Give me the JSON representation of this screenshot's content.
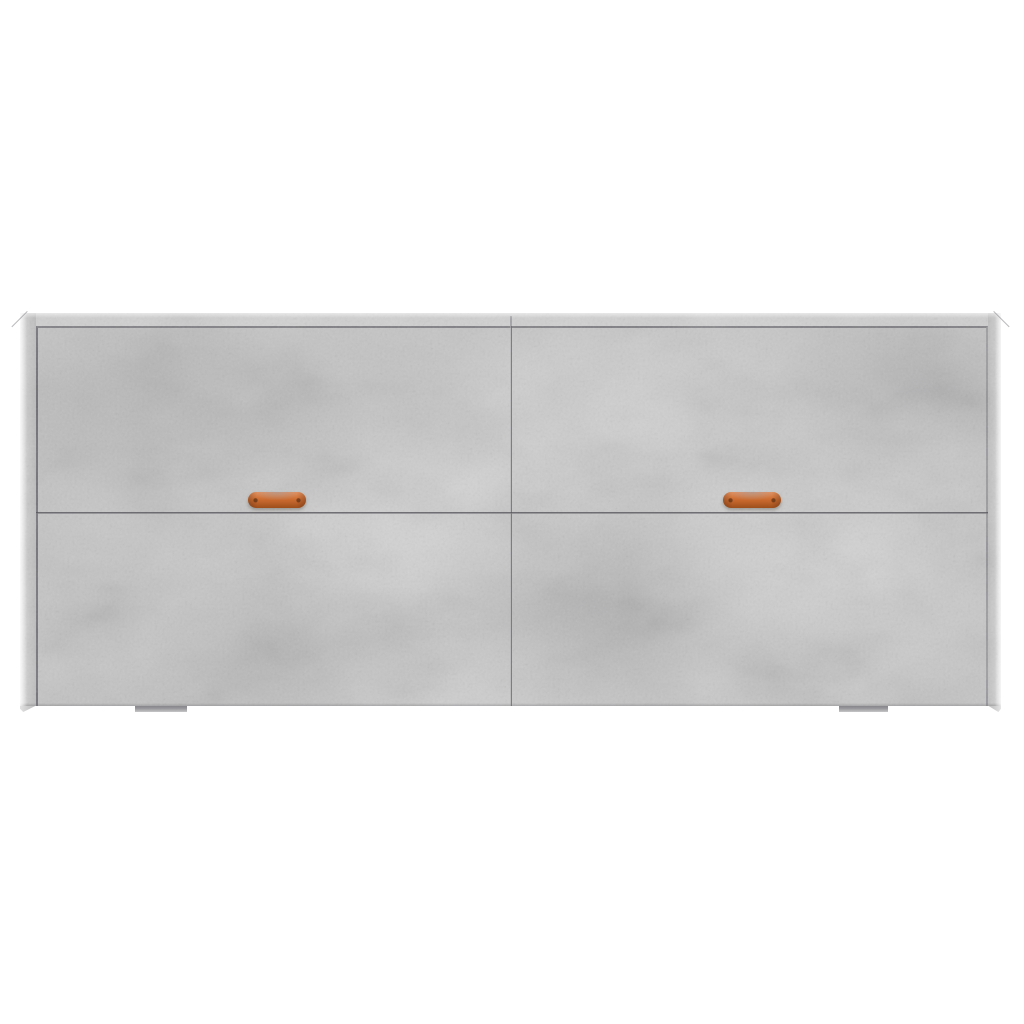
{
  "scene": {
    "description": "Front view of a wide concrete-grey sideboard cabinet with two columns of doors, two copper strap handles and two low plinth feet, on a plain white background",
    "background_color": "#ffffff"
  },
  "colors": {
    "background": "#ffffff",
    "frame": "#d2d2d2",
    "door": "#c4c4c4",
    "seam": "#5e5e63",
    "handle": "#c96a2f",
    "handle_highlight": "#e6915c",
    "handle_shadow": "#9e4e1b",
    "foot": "#9a9a9e"
  },
  "cabinet": {
    "panel_columns": 2,
    "panel_rows": 2,
    "handle_count": 2,
    "foot_count": 2
  }
}
